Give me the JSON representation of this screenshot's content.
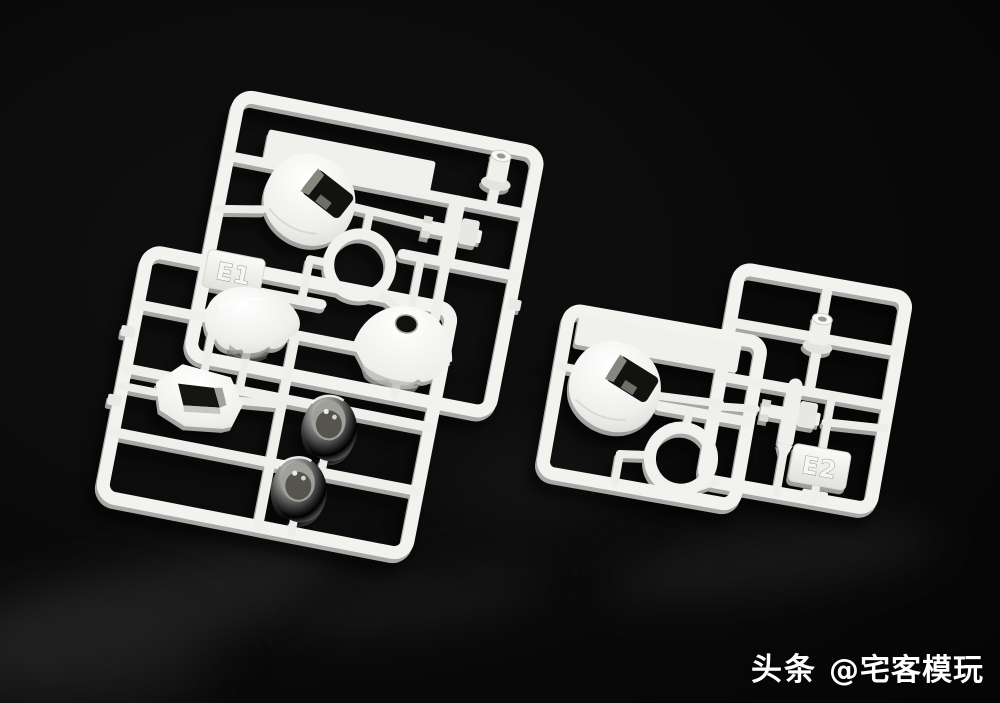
{
  "scene": {
    "description": "Two white plastic model-kit part runners (sprues E1 and E2) photographed on a glossy black surface",
    "background_color": "#090909",
    "plastic_color": "#f2f2ef"
  },
  "sprues": [
    {
      "tag_label": "E1",
      "position": "left",
      "parts": [
        "head-shell",
        "ring",
        "top-peg",
        "cross-joint",
        "dome-shell-with-hole",
        "rounded-body-shell",
        "angular-visor-frame",
        "ball-socket-cup",
        "ball-socket-cup"
      ]
    },
    {
      "tag_label": "E2",
      "position": "right",
      "parts": [
        "head-shell",
        "top-peg",
        "cross-joint",
        "ring"
      ]
    }
  ],
  "watermark": {
    "brand": "头条",
    "handle": "@宅客模玩",
    "color": "#ffffff"
  }
}
